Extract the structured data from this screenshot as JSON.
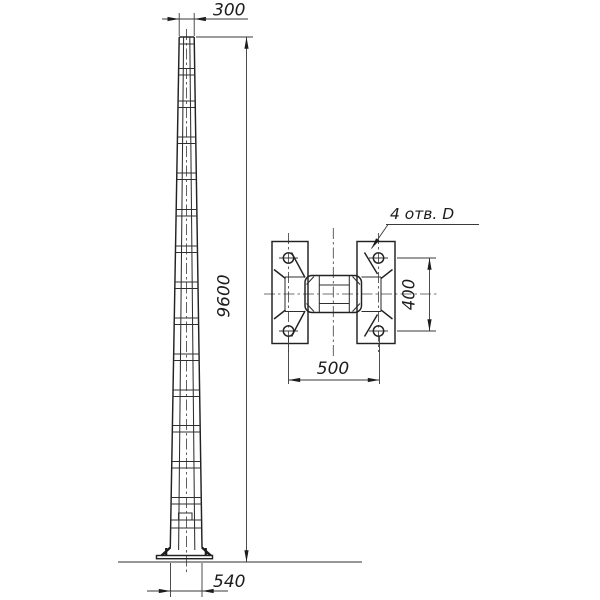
{
  "canvas": {
    "background": "#ffffff",
    "line_color": "#2f2f2f"
  },
  "pole_elevation": {
    "dim_top_width": "300",
    "dim_height": "9600",
    "dim_base_width": "540"
  },
  "flange_plan": {
    "hole_callout": "4 отв. D",
    "dim_bolt_spacing_horizontal": "500",
    "dim_bolt_spacing_vertical": "400"
  }
}
